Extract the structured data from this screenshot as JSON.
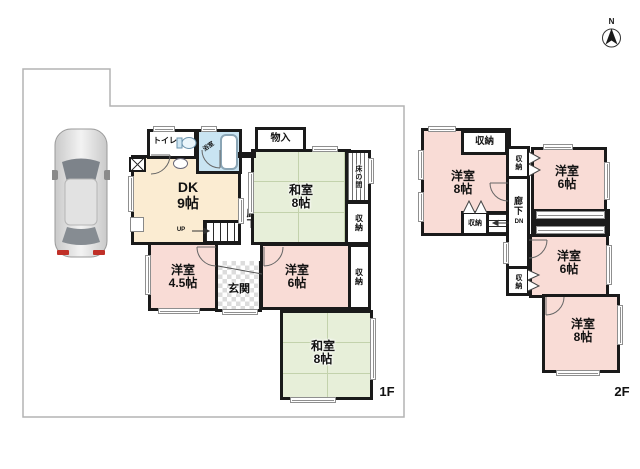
{
  "compass": {
    "label": "N"
  },
  "floor1": {
    "floor_label": "1F",
    "rooms": {
      "toilet": {
        "name": "トイレ"
      },
      "bath": {
        "name": "浴室"
      },
      "dk": {
        "name": "DK",
        "size": "9帖"
      },
      "storage_top": {
        "name": "物入"
      },
      "washitsu_top": {
        "name": "和室",
        "size": "8帖"
      },
      "tokonoma": {
        "name": "床の間"
      },
      "closet_upper": {
        "name": "収納"
      },
      "closet_lower": {
        "name": "収納"
      },
      "hallway": {
        "name": "廊下"
      },
      "stairs": {
        "label": "UP"
      },
      "western_45": {
        "name": "洋室",
        "size": "4.5帖"
      },
      "entrance": {
        "name": "玄関"
      },
      "western_6": {
        "name": "洋室",
        "size": "6帖"
      },
      "washitsu_btm": {
        "name": "和室",
        "size": "8帖"
      }
    }
  },
  "floor2": {
    "floor_label": "2F",
    "rooms": {
      "western_8_nw": {
        "name": "洋室",
        "size": "8帖"
      },
      "closet_top": {
        "name": "収納"
      },
      "closet_sw": {
        "name": "収納"
      },
      "stairs": {
        "label": "DN"
      },
      "closet_mid": {
        "name": "収納"
      },
      "hallway": {
        "name": "廊下"
      },
      "closet_btm": {
        "name": "収納"
      },
      "western_6_ne": {
        "name": "洋室",
        "size": "6帖"
      },
      "western_6_e": {
        "name": "洋室",
        "size": "6帖"
      },
      "western_8_se": {
        "name": "洋室",
        "size": "8帖"
      }
    }
  },
  "colors": {
    "wall": "#1a1a1a",
    "tatami_room": "#e7efd9",
    "western_room": "#f9dcd6",
    "dk_room": "#fbecd2",
    "bath_room": "#c9e4f2",
    "boundary_line": "#b3b3b3",
    "taillight": "#c03028"
  }
}
